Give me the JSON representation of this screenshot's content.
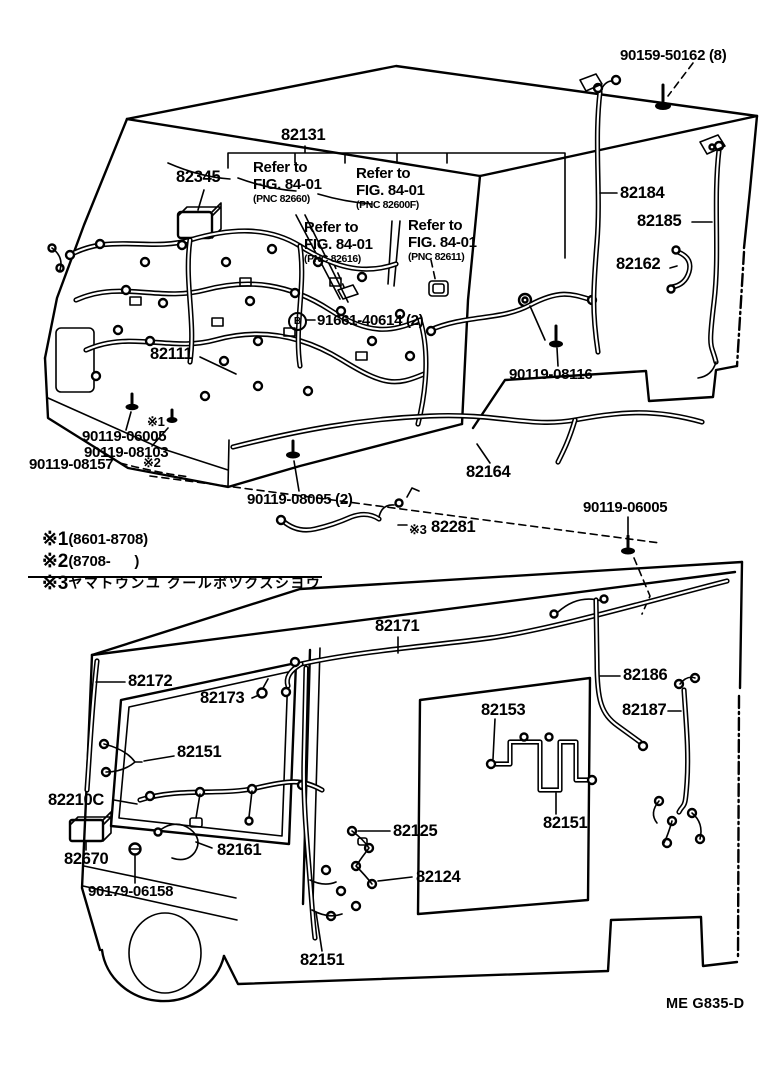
{
  "doc": {
    "type_note": "vehicle wiring-harness parts diagram, two cab views",
    "footer_code": "ME G835-D",
    "ink": "#000000",
    "bg": "#ffffff"
  },
  "marker_b": "B",
  "refs": [
    {
      "line1": "Refer to",
      "line2": "FIG. 84-01",
      "line3": "(PNC 82660)"
    },
    {
      "line1": "Refer to",
      "line2": "FIG. 84-01",
      "line3": "(PNC 82600F)"
    },
    {
      "line1": "Refer to",
      "line2": "FIG. 84-01",
      "line3": "(PNC 82616)"
    },
    {
      "line1": "Refer to",
      "line2": "FIG. 84-01",
      "line3": "(PNC 82611)"
    }
  ],
  "labels": {
    "p90159": "90159-50162 (8)",
    "p82131": "82131",
    "p82345": "82345",
    "p82184": "82184",
    "p82185": "82185",
    "p82162": "82162",
    "p91661": "91661-40614 (2)",
    "p82111": "82111",
    "p90119_08116": "90119-08116",
    "star1": "※1",
    "p90119_06005a": "90119-06005",
    "p90119_08103": "90119-08103",
    "star2": "※2",
    "p90119_08157": "90119-08157",
    "p82164": "82164",
    "p90119_08005": "90119-08005 (2)",
    "star3": "※3",
    "p82281": "82281",
    "p90119_06005b": "90119-06005",
    "p82171": "82171",
    "p82172": "82172",
    "p82173": "82173",
    "p82151a": "82151",
    "p82186": "82186",
    "p82153": "82153",
    "p82187": "82187",
    "p82151b": "82151",
    "p82210c": "82210C",
    "p82670": "82670",
    "p82161": "82161",
    "p90179": "90179-06158",
    "p82125": "82125",
    "p82124": "82124",
    "p82151c": "82151",
    "footer": "ME G835-D"
  },
  "legend": {
    "rows": [
      {
        "marker": "※1",
        "text": "(8601-8708)",
        "jp": ""
      },
      {
        "marker": "※2",
        "text": "(8708-      )",
        "jp": ""
      },
      {
        "marker": "※3",
        "text": "",
        "jp": "ヤマトウンユ クールボツクスシヨウ"
      }
    ]
  }
}
